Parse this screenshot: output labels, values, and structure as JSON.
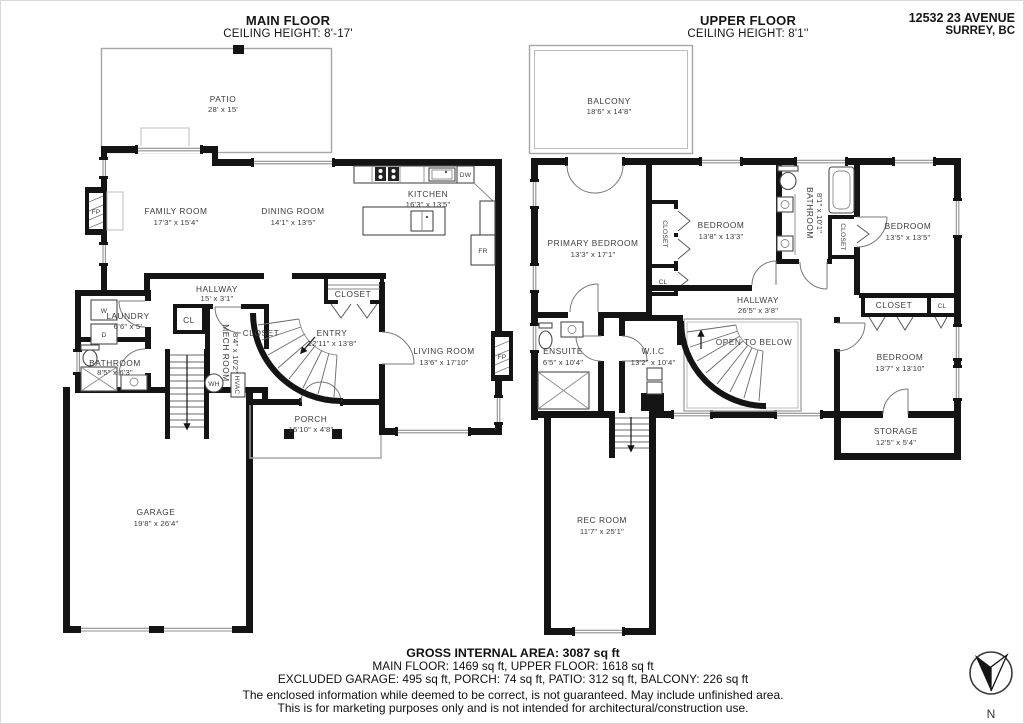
{
  "header": {
    "main_title": "MAIN FLOOR",
    "main_ceiling": "CEILING HEIGHT: 8'-17'",
    "upper_title": "UPPER FLOOR",
    "upper_ceiling": "CEILING HEIGHT: 8'1''",
    "address1": "12532 23 AVENUE",
    "address2": "SURREY, BC"
  },
  "main": {
    "patio": {
      "name": "PATIO",
      "dims": "28' x 15'"
    },
    "family_room": {
      "name": "FAMILY ROOM",
      "dims": "17'3\" x 15'4\""
    },
    "dining_room": {
      "name": "DINING ROOM",
      "dims": "14'1\" x 13'5\""
    },
    "kitchen": {
      "name": "KITCHEN",
      "dims": "16'3\" x 13'5\""
    },
    "living_room": {
      "name": "LIVING ROOM",
      "dims": "13'6\" x 17'10\""
    },
    "hallway": {
      "name": "HALLWAY",
      "dims": "15' x 3'1\""
    },
    "laundry": {
      "name": "LAUNDRY",
      "dims": "6'6\" x 5'"
    },
    "bathroom": {
      "name": "BATHROOM",
      "dims": "8'5\" x 6'3\""
    },
    "mech_room": {
      "name": "MECH ROOM",
      "dims": "8'4\" x 10'2\""
    },
    "entry": {
      "name": "ENTRY",
      "dims": "12'11\" x 13'8\""
    },
    "porch": {
      "name": "PORCH",
      "dims": "15'10\" x 4'8\""
    },
    "garage": {
      "name": "GARAGE",
      "dims": "19'8\" x 26'4\""
    },
    "closet_understair": "CLOSET",
    "closet_entry": "CLOSET",
    "cl": "CL",
    "fixtures": {
      "fp": "FP",
      "dw": "DW",
      "fr": "FR",
      "wh": "WH",
      "hvac": "HVAC",
      "washer": "W",
      "dryer": "D"
    }
  },
  "upper": {
    "balcony": {
      "name": "BALCONY",
      "dims": "18'6\" x 14'8\""
    },
    "primary_bedroom": {
      "name": "PRIMARY BEDROOM",
      "dims": "13'3\" x 17'1\""
    },
    "bedroom_mid": {
      "name": "BEDROOM",
      "dims": "13'8\" x 13'3\""
    },
    "bathroom": {
      "name": "BATHROOM",
      "dims": "8'1\" x 10'1\""
    },
    "bedroom_right": {
      "name": "BEDROOM",
      "dims": "13'5\" x 13'5\""
    },
    "bedroom_bottom": {
      "name": "BEDROOM",
      "dims": "13'7\" x 13'10\""
    },
    "hallway": {
      "name": "HALLWAY",
      "dims": "26'5\" x 3'8\""
    },
    "open_to_below": "OPEN TO BELOW",
    "wic": {
      "name": "W.I.C",
      "dims": "13'2\" x 10'4\""
    },
    "ensuite": {
      "name": "ENSUITE",
      "dims": "6'5\" x 10'4\""
    },
    "storage": {
      "name": "STORAGE",
      "dims": "12'5\" x 5'4\""
    },
    "rec_room": {
      "name": "REC ROOM",
      "dims": "11'7\" x 25'1\""
    },
    "closet_a": "CLOSET",
    "closet_b": "CLOSET",
    "closet_c": "CLOSET",
    "cl_a": "CL",
    "cl_b": "CL"
  },
  "footer": {
    "gross": "GROSS INTERNAL AREA: 3087 sq ft",
    "floors": "MAIN FLOOR: 1469 sq ft, UPPER FLOOR: 1618 sq ft",
    "excluded": "EXCLUDED GARAGE: 495 sq ft, PORCH: 74 sq ft, PATIO: 312 sq ft, BALCONY: 226 sq ft",
    "disclaimer1": "The enclosed information while deemed to be correct, is not guaranteed. May include unfinished area.",
    "disclaimer2": "This is for marketing purposes only and is not intended for architectural/construction use.",
    "compass": "N"
  },
  "colors": {
    "wall": "#141414",
    "label": "#3c3c3c",
    "deck_line": "#a6a6a6"
  }
}
